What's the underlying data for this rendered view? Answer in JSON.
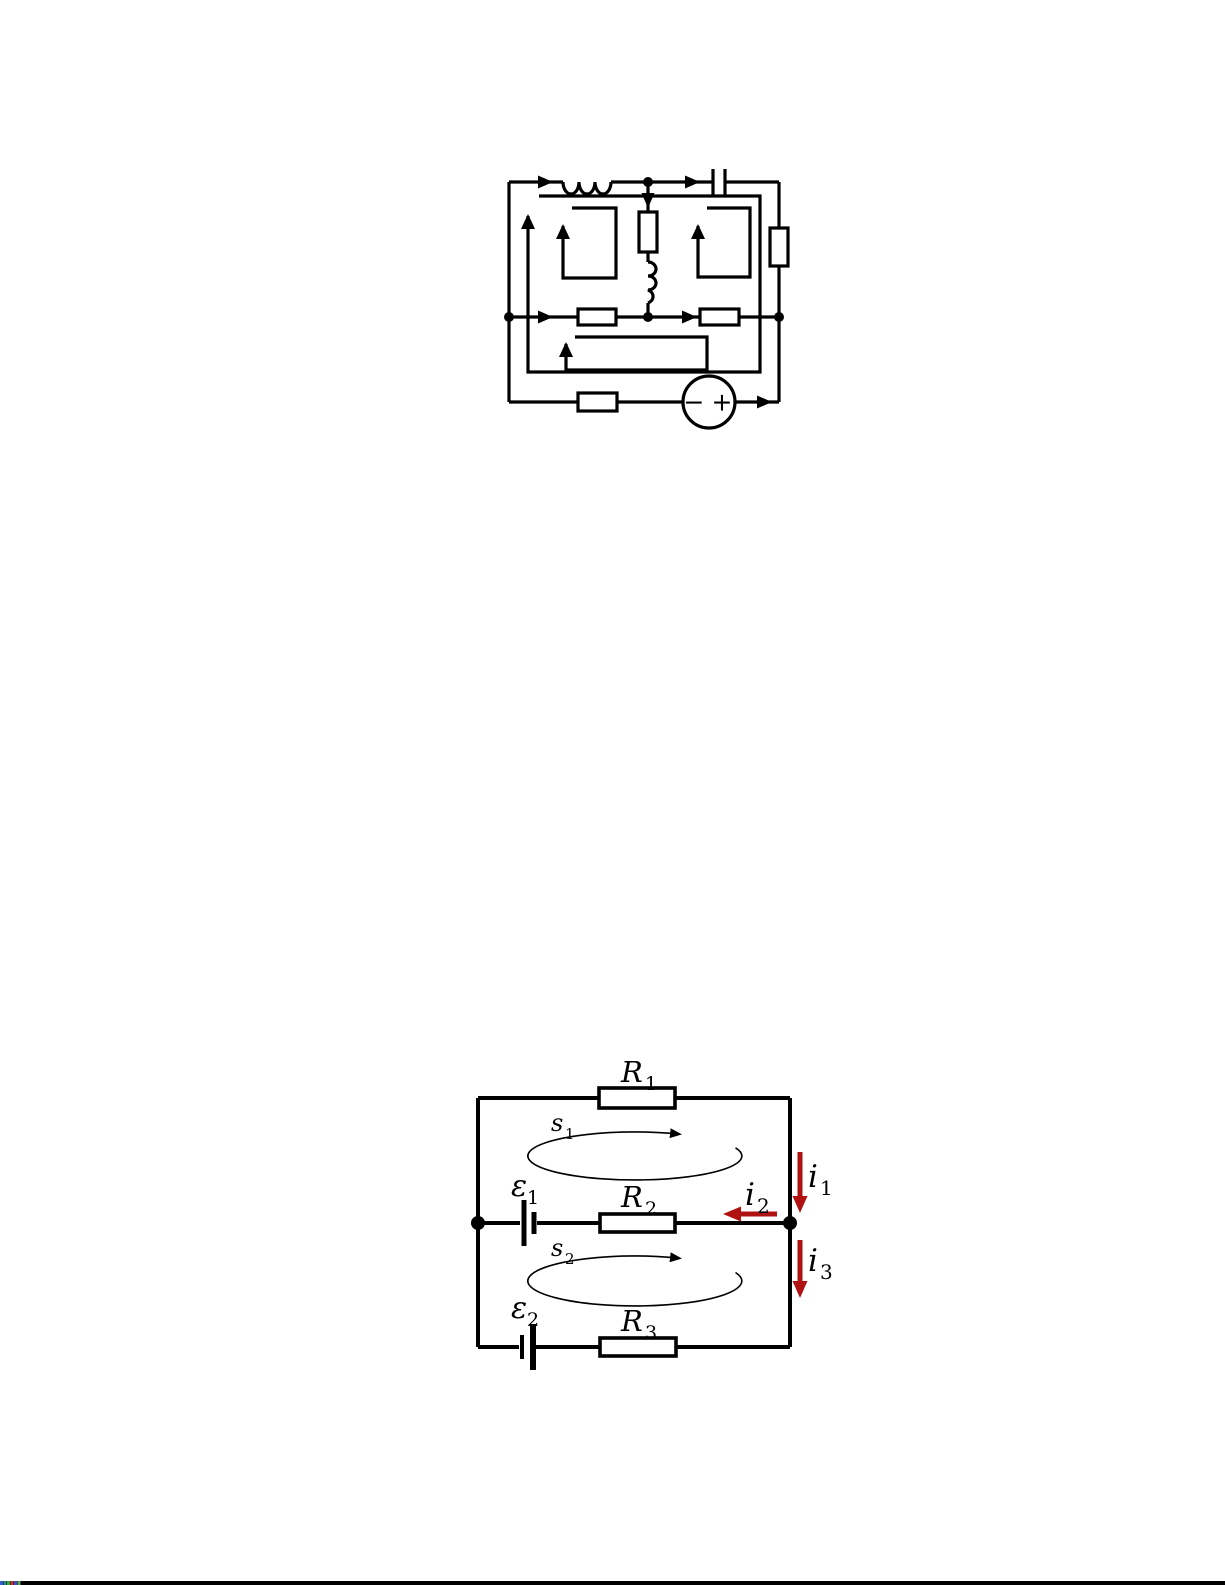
{
  "figure1": {
    "source_labels": {
      "minus": "−",
      "plus": "+"
    }
  },
  "figure2": {
    "labels": {
      "r1": {
        "base": "R",
        "sub": "1"
      },
      "r2": {
        "base": "R",
        "sub": "2"
      },
      "r3": {
        "base": "R",
        "sub": "3"
      },
      "s1": {
        "base": "s",
        "sub": "1"
      },
      "s2": {
        "base": "s",
        "sub": "2"
      },
      "emf1": {
        "base": "ε",
        "sub": "1"
      },
      "emf2": {
        "base": "ε",
        "sub": "2"
      },
      "i1": {
        "base": "i",
        "sub": "1"
      },
      "i2": {
        "base": "i",
        "sub": "2"
      },
      "i3": {
        "base": "i",
        "sub": "3"
      }
    },
    "colors": {
      "wire": "#000000",
      "current": "#b01212"
    }
  },
  "bottom_bar": {
    "bar_color": "#000000",
    "artifact_colors": [
      "#3b5bd0",
      "#2e8b8b",
      "#3aa53a",
      "#c03a2e",
      "#4948c8",
      "#57a757"
    ]
  }
}
